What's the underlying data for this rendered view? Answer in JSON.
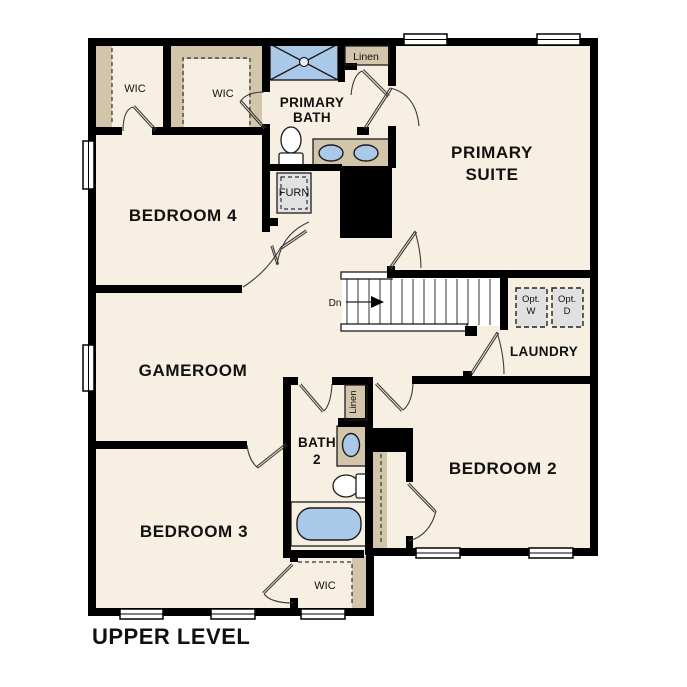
{
  "colors": {
    "bg": "#ffffff",
    "wall": "#000000",
    "room": "#f7efe2",
    "tan": "#d2c5aa",
    "blue": "#aac8e8",
    "gray": "#e1e1e1",
    "line": "#1c1c1c",
    "text": "#111111"
  },
  "plan": {
    "level_label": "UPPER LEVEL",
    "rooms": {
      "wic_a": "WIC",
      "wic_b": "WIC",
      "primary_bath": [
        "PRIMARY",
        "BATH"
      ],
      "linen_a": "Linen",
      "primary_suite": [
        "PRIMARY",
        "SUITE"
      ],
      "bedroom4": "BEDROOM 4",
      "furn": "FURN",
      "gameroom": "GAMEROOM",
      "laundry": "LAUNDRY",
      "opt_washer": [
        "Opt.",
        "W"
      ],
      "opt_dryer": [
        "Opt.",
        "D"
      ],
      "bath2": [
        "BATH",
        "2"
      ],
      "linen_b": "Linen",
      "bedroom2": "BEDROOM 2",
      "bedroom3": "BEDROOM 3",
      "wic_c": "WIC"
    },
    "stairs": {
      "direction_label": "Dn"
    }
  }
}
